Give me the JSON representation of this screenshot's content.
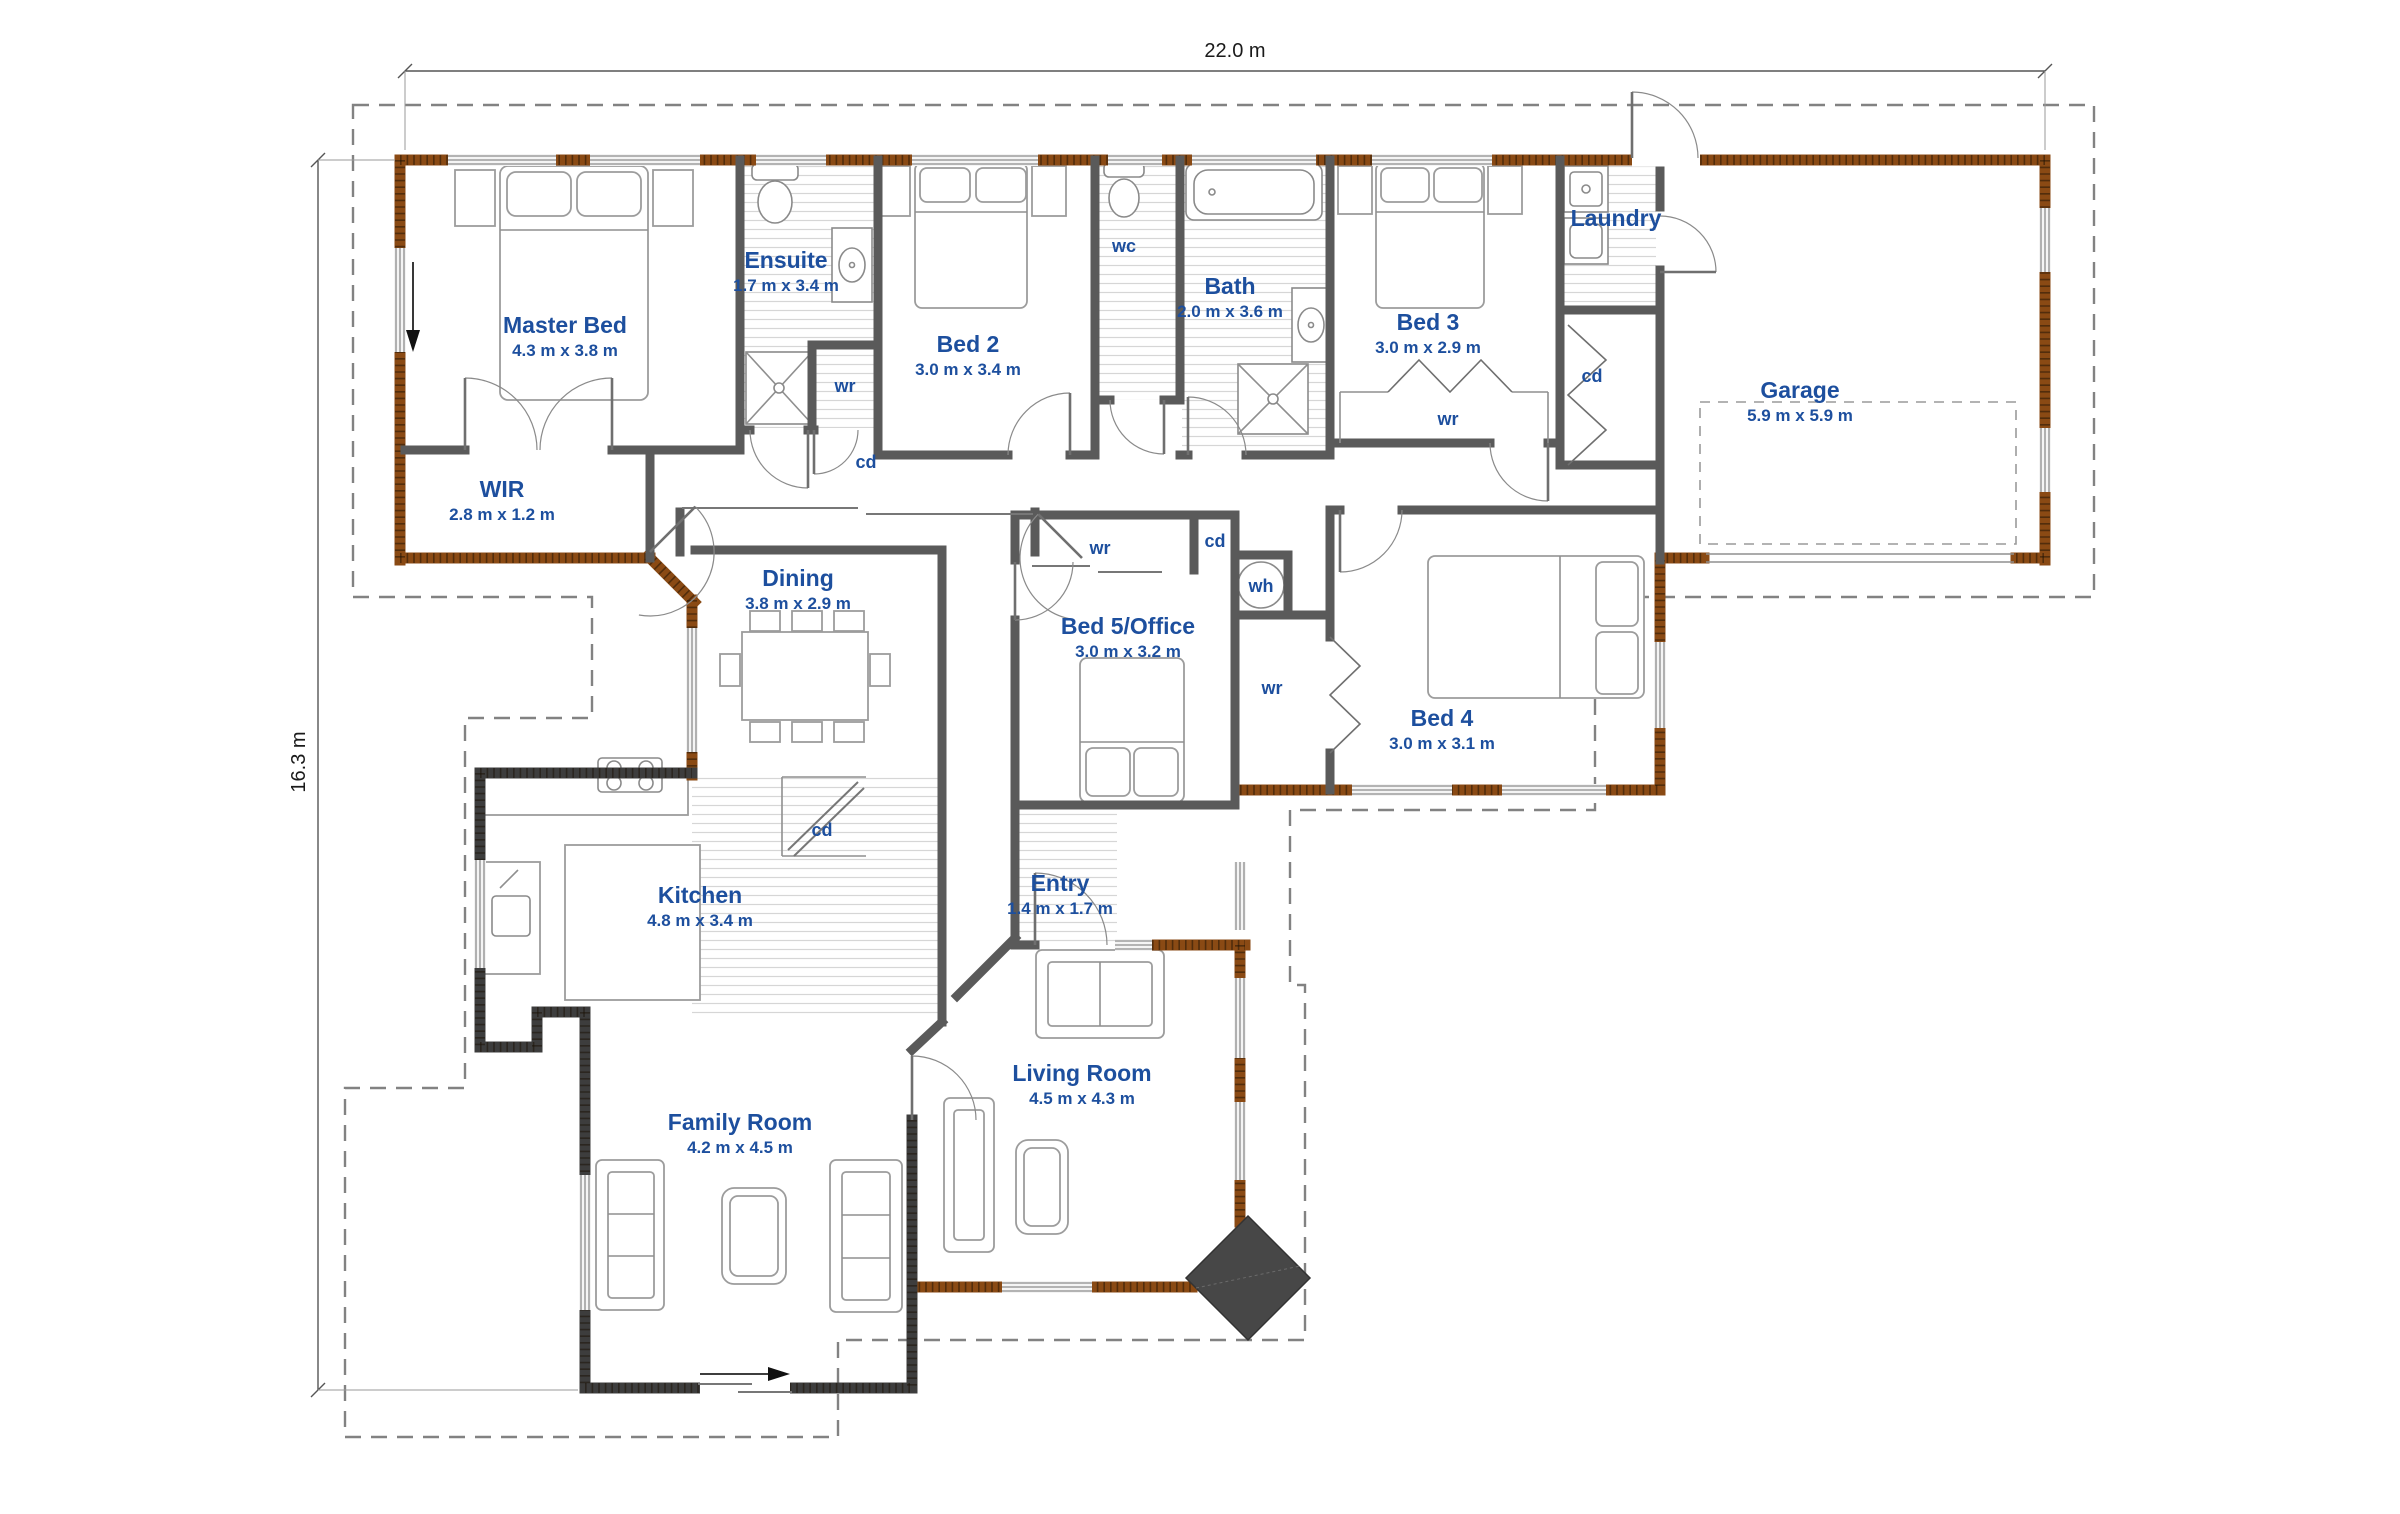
{
  "plan": {
    "dimensions": {
      "width_label": "22.0 m",
      "height_label": "16.3 m"
    },
    "rooms": [
      {
        "name": "Master Bed",
        "dims": "4.3 m x 3.8 m"
      },
      {
        "name": "Ensuite",
        "dims": "1.7 m x 3.4 m"
      },
      {
        "name": "Bed 2",
        "dims": "3.0 m x 3.4 m"
      },
      {
        "name": "wc",
        "dims": ""
      },
      {
        "name": "Bath",
        "dims": "2.0 m x 3.6 m"
      },
      {
        "name": "Bed 3",
        "dims": "3.0 m x 2.9 m"
      },
      {
        "name": "Laundry",
        "dims": ""
      },
      {
        "name": "Garage",
        "dims": "5.9 m x 5.9 m"
      },
      {
        "name": "WIR",
        "dims": "2.8 m x 1.2 m"
      },
      {
        "name": "Dining",
        "dims": "3.8 m x 2.9 m"
      },
      {
        "name": "Bed 5/Office",
        "dims": "3.0 m x 3.2 m"
      },
      {
        "name": "Bed 4",
        "dims": "3.0 m x 3.1 m"
      },
      {
        "name": "Kitchen",
        "dims": "4.8 m x 3.4 m"
      },
      {
        "name": "Entry",
        "dims": "1.4 m x 1.7 m"
      },
      {
        "name": "Family Room",
        "dims": "4.2 m x 4.5 m"
      },
      {
        "name": "Living Room",
        "dims": "4.5 m x 4.3 m"
      }
    ],
    "closet_labels": {
      "wr": "wr",
      "cd": "cd",
      "wh": "wh"
    },
    "colors": {
      "label_blue": "#1d4f9e",
      "wall_gray": "#5a5a5a",
      "wall_dark": "#3d3d3d",
      "brick_brown": "#8a4a14",
      "window_line": "#8c8c8c",
      "boundary": "#828282",
      "fireplace": "#474747",
      "dim_text": "#1a1a1a"
    }
  }
}
